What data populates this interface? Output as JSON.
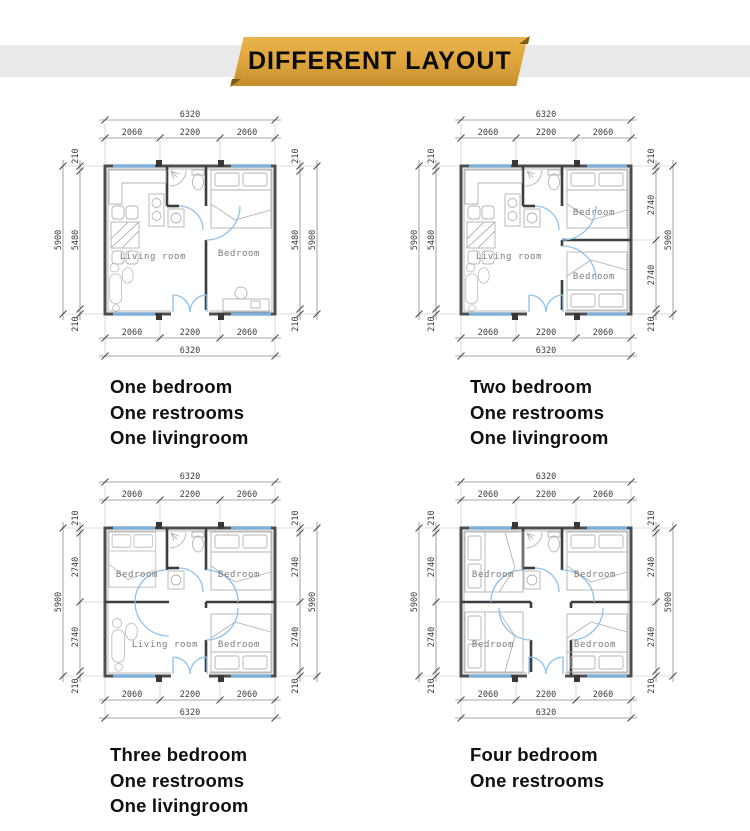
{
  "banner": {
    "label": "DIFFERENT LAYOUT",
    "bg_color": "#dda33c",
    "stripe_color": "#eaeaea",
    "text_color": "#0a0a0a"
  },
  "colors": {
    "wall": "#4d4d4d",
    "window": "#74b1e4",
    "door_arc": "#8cc2ee",
    "furniture": "#b3b3b3",
    "dimension_text": "#3c3c3c",
    "room_text": "#7a7a7a"
  },
  "plans": [
    {
      "id": "one-bedroom",
      "caption_lines": [
        "One bedroom",
        "One restrooms",
        "One livingroom"
      ],
      "rooms": {
        "living": "Living room",
        "bedroom": "Bedroom"
      },
      "dims": {
        "total_w": "6320",
        "seg_w": [
          "2060",
          "2200",
          "2060"
        ],
        "total_h": "5900",
        "left": [
          "210",
          "5480",
          "210"
        ],
        "right": [
          "210",
          "5480",
          "210"
        ]
      }
    },
    {
      "id": "two-bedroom",
      "caption_lines": [
        "Two bedroom",
        "One restrooms",
        "One livingroom"
      ],
      "rooms": {
        "living": "Living room",
        "bedroom_top": "Bedroom",
        "bedroom_bottom": "Bedroom"
      },
      "dims": {
        "total_w": "6320",
        "seg_w": [
          "2060",
          "2200",
          "2060"
        ],
        "total_h": "5900",
        "left": [
          "210",
          "5480",
          "210"
        ],
        "right": [
          "210",
          "2740",
          "2740",
          "210"
        ]
      }
    },
    {
      "id": "three-bedroom",
      "caption_lines": [
        "Three bedroom",
        "One restrooms",
        "One livingroom"
      ],
      "rooms": {
        "bedroom_tl": "Bedroom",
        "bedroom_tr": "Bedroom",
        "living": "Living room",
        "bedroom_br": "Bedroom"
      },
      "dims": {
        "total_w": "6320",
        "seg_w": [
          "2060",
          "2200",
          "2060"
        ],
        "total_h": "5900",
        "left": [
          "210",
          "2740",
          "2740",
          "210"
        ],
        "right": [
          "210",
          "2740",
          "2740",
          "210"
        ]
      }
    },
    {
      "id": "four-bedroom",
      "caption_lines": [
        "Four bedroom",
        "One restrooms"
      ],
      "rooms": {
        "bedroom_tl": "Bedroom",
        "bedroom_tr": "Bedroom",
        "bedroom_bl": "Bedroom",
        "bedroom_br": "Bedroom"
      },
      "dims": {
        "total_w": "6320",
        "seg_w": [
          "2060",
          "2200",
          "2060"
        ],
        "total_h": "5900",
        "left": [
          "210",
          "2740",
          "2740",
          "210"
        ],
        "right": [
          "210",
          "2740",
          "2740",
          "210"
        ]
      }
    }
  ]
}
